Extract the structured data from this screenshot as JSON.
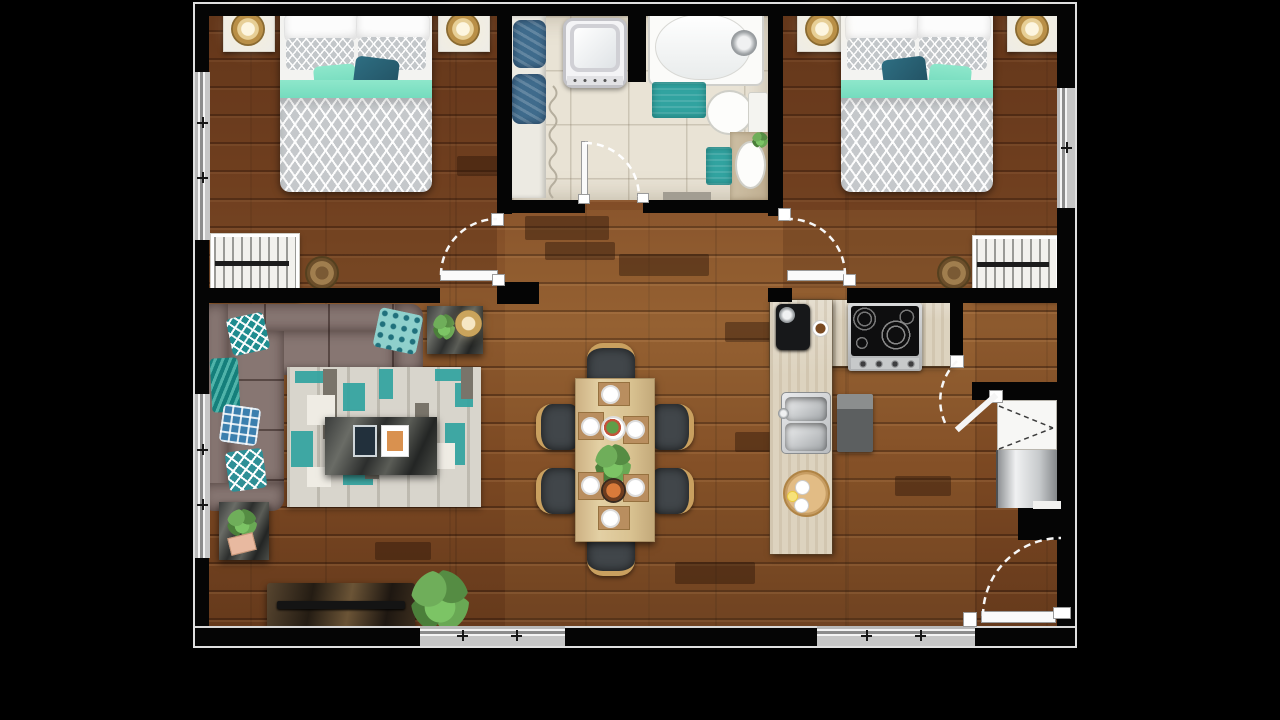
{
  "scene": {
    "type": "apartment-floor-plan-top-view",
    "style": "3d-rendered floor plan on black background, dark walnut wood floors, black walls, white door leaves and dashed swing arcs, gray window symbols",
    "rooms": [
      {
        "name": "bedroom-1",
        "position": "top-left",
        "furniture": [
          "double-bed-chevron-duvet",
          "white-pillows",
          "mint-accent-pillow",
          "teal-accent-pillow",
          "nightstand-left",
          "brass-lamp-left",
          "nightstand-right",
          "brass-lamp-right",
          "slatted-dresser",
          "round-basket",
          "window-left-wall",
          "door-to-hall"
        ]
      },
      {
        "name": "bathroom",
        "position": "top-center",
        "furniture": [
          "towel-shelf",
          "folded-towels-x2",
          "shower-curtain",
          "washing-machine",
          "bathtub-with-faucet",
          "teal-bath-mat-x2",
          "toilet",
          "wood-vanity-with-round-sink",
          "small-plant",
          "threshold-mat",
          "door-to-hall"
        ]
      },
      {
        "name": "bedroom-2",
        "position": "top-right",
        "furniture": [
          "double-bed-chevron-duvet",
          "white-pillows",
          "teal-accent-pillow",
          "mint-accent-pillow",
          "nightstand-left",
          "brass-lamp-left",
          "nightstand-right",
          "brass-lamp-right",
          "slatted-dresser",
          "round-basket",
          "window-right-wall",
          "door-to-hall"
        ]
      },
      {
        "name": "living-room",
        "position": "bottom-left",
        "furniture": [
          "l-shaped-corner-sofa",
          "chevron-teal-pillow",
          "patterned-teal-pillows-x3",
          "teal-throw-blanket",
          "geometric-area-rug",
          "dark-marble-coffee-table",
          "two-books",
          "side-table-with-gold-bowl-and-plant",
          "side-table-with-plant-and-book",
          "tv-console",
          "flat-tv",
          "large-potted-plant",
          "window-left-wall",
          "window-bottom-wall"
        ]
      },
      {
        "name": "dining-area",
        "position": "center",
        "furniture": [
          "rectangular-wood-table",
          "dining-chairs-x6",
          "serving-trays-with-plates-x6",
          "salad-bowl",
          "food-bowl",
          "herb-centerpiece-plant"
        ]
      },
      {
        "name": "kitchen",
        "position": "center-right",
        "furniture": [
          "l-shaped-travertine-counter",
          "espresso-machine",
          "coffee-cup",
          "four-burner-cooktop",
          "double-stainless-sink",
          "gray-floor-mat",
          "round-serving-board-with-cups-and-lemon",
          "open-door-leaf"
        ]
      },
      {
        "name": "pantry-nook",
        "position": "right",
        "furniture": [
          "closet-cabinet-dashed-symbol",
          "refrigerator"
        ]
      },
      {
        "name": "entry",
        "position": "bottom-right",
        "furniture": [
          "entry-door-leaf",
          "dashed-swing-arc",
          "window-bottom-wall"
        ]
      }
    ],
    "counts": {
      "bedrooms": 2,
      "bathrooms": 1,
      "dining_chairs": 6,
      "windows": 5,
      "doors": 6
    }
  },
  "palette": {
    "wall": "#050505",
    "outline": "#e0e0e0",
    "wood_base": "#7a4726",
    "wood_light": "#8d5a2e",
    "wood_dark": "#5e3419",
    "tile": "#e9e3d5",
    "counter": "#ddd3bf",
    "teal": "#31a3a0",
    "mint": "#7fe4c5",
    "teal_dark": "#2a6578",
    "steel_blue": "#3f6b8c",
    "sofa": "#877672",
    "rug_base": "#d8d5cc",
    "duvet_gray": "#c5c8cb",
    "dining_wood": "#dcc79a",
    "chair_dark": "#41464a",
    "chair_wood": "#c9a05f",
    "gold": "#c9a45c",
    "marble": "#3e403f",
    "fridge_silver": "#d4d6d8",
    "door_leaf": "#fafafa"
  }
}
